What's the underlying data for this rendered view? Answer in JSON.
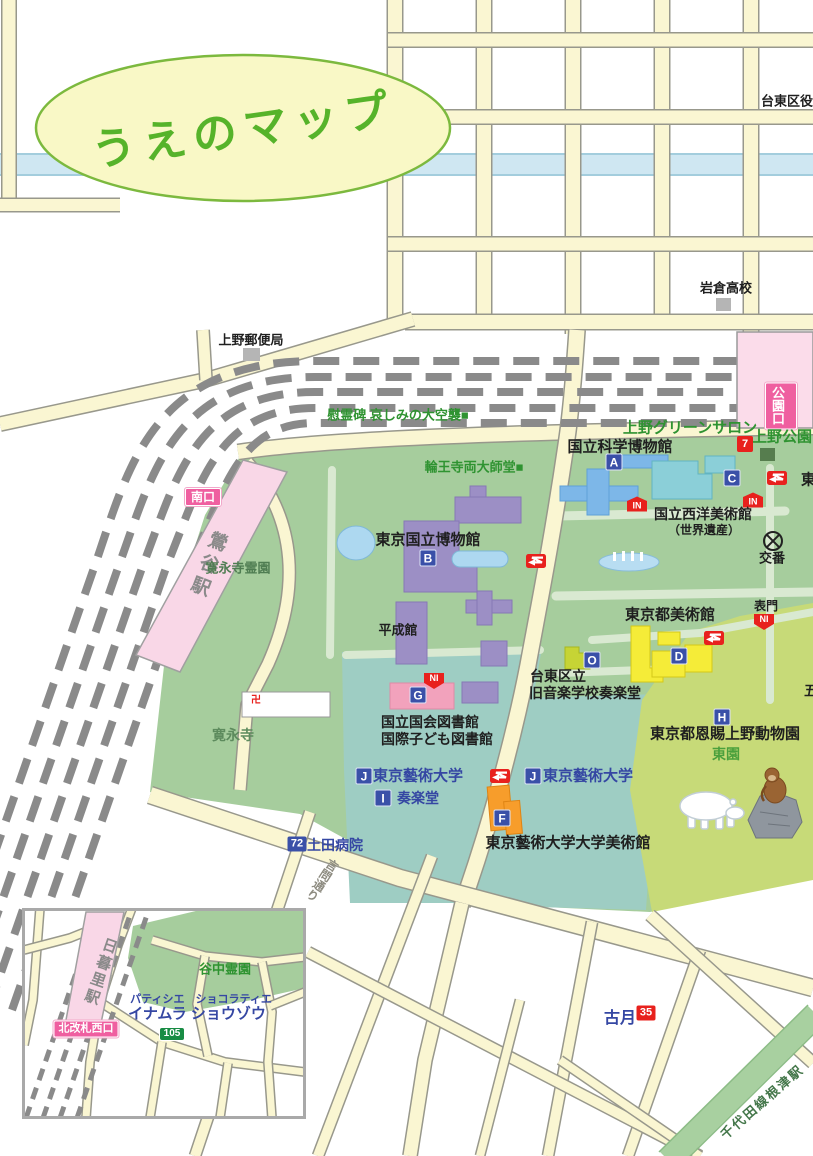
{
  "title": "うえのマップ",
  "colors": {
    "road": "#faf6d2",
    "road_border": "#98988c",
    "river": "#cfe7f2",
    "park_green": "#a6cd9d",
    "teal_green": "#9ecdc3",
    "zoo_green": "#c7da78",
    "path_pale": "#d9e9d1",
    "station_pink": "#fbdcea",
    "exit_pink": "#ef5fa0",
    "badge_blue": "#3a50a8",
    "badge_red": "#e8211d",
    "badge_green": "#188c44",
    "building_purple": "#9c8fc5",
    "building_blue": "#7db7e8",
    "building_cyan": "#8bcfd8",
    "building_yellow": "#f5ec38",
    "building_pink": "#f2a2bc",
    "building_orange": "#f79d2b",
    "building_chartreuse": "#c6d435",
    "title_green": "#56b32a"
  },
  "labels": {
    "ward_office": "台東区役所",
    "iwakura_high": "岩倉高校",
    "post_office": "上野郵便局",
    "memorial": "慰霊碑 哀しみの大空襲■",
    "rinnoji": "輪王寺両大師堂■",
    "green_salon": "上野グリーンサロン",
    "ueno_park": "上野公園",
    "science_museum": "国立科学博物館",
    "western_art": "国立西洋美術館",
    "world_heritage": "（世界遺産）",
    "koban": "交番",
    "east_partial": "東",
    "five_partial": "五",
    "national_museum": "東京国立博物館",
    "heiseikan": "平成館",
    "taito_l1": "台東区立",
    "taito_l2": "旧音楽学校奏楽堂",
    "library_l1": "国立国会図書館",
    "library_l2": "国際子ども図書館",
    "metro_art": "東京都美術館",
    "omote_gate": "表門",
    "zoo": "東京都恩賜上野動物園",
    "east_garden": "東園",
    "geidai_west": "東京藝術大学",
    "geidai_east": "東京藝術大学",
    "sogakudo": "奏楽堂",
    "geidai_museum": "東京藝術大学大学美術館",
    "hospital": "土田病院",
    "kaneiji": "寛永寺",
    "kaneiji_cemetery": "寛永寺霊園",
    "kototoi_dori": "言問通り",
    "kogetsu": "古月",
    "nezu_line": "千代田線根津駅",
    "yanaka_cemetery": "谷中霊園",
    "patissier": "パティシエ　ショコラティエ",
    "inamura": "イナムラ ショウゾウ",
    "temple_mark": "卍"
  },
  "stations": {
    "uguisudani": "鶯谷駅",
    "nippori": "日暮里駅",
    "park_exit": "公園口",
    "south_exit": "南口",
    "north_west_exit": "北改札西口"
  },
  "badges": {
    "a": "A",
    "b": "B",
    "c": "C",
    "d": "D",
    "f": "F",
    "g": "G",
    "h": "H",
    "i": "I",
    "j": "J",
    "o": "O",
    "in": "IN",
    "ni": "NI",
    "n7": "7",
    "n35": "35",
    "n72": "72",
    "n105": "105"
  }
}
